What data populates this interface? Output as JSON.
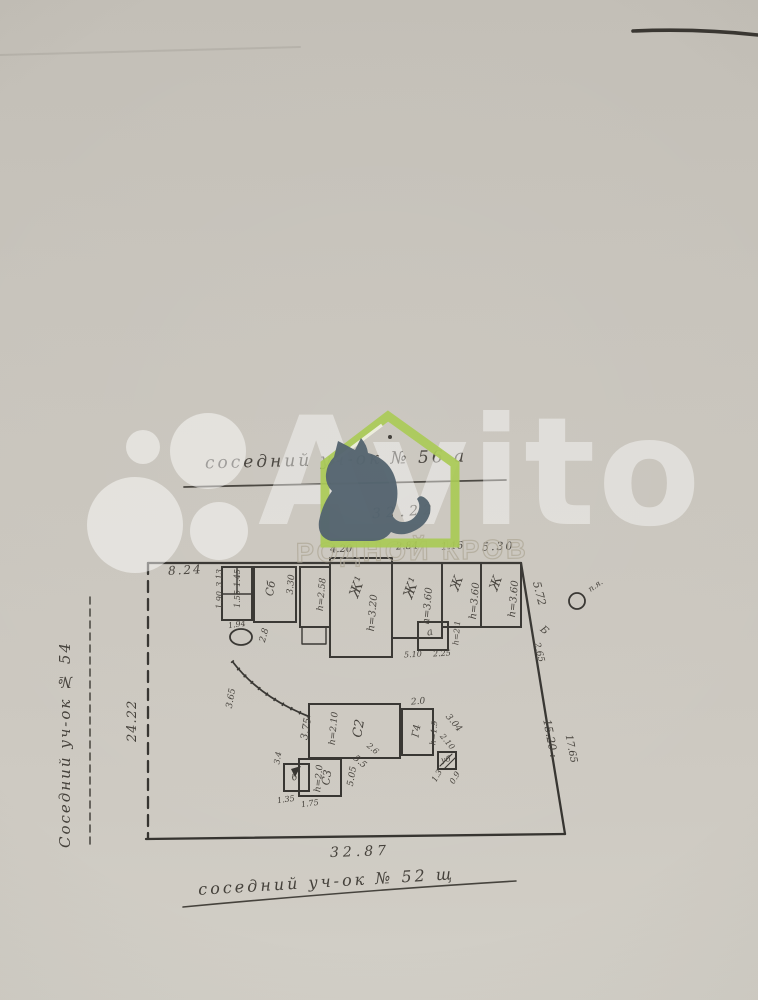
{
  "watermark": {
    "brand_text": "Avito",
    "band_text": "РОДНОЙ КРОВ",
    "colors": {
      "house_green": "#a6c84e",
      "cat_slate": "#4d5e69",
      "logo_white": "rgba(255,255,255,0.45)"
    }
  },
  "plan": {
    "neighbor_top": "соседний  уч-ок  № 56 а",
    "neighbor_left": "Соседний  уч-ок  № 54",
    "neighbor_bottom": "соседний  уч-ок  № 52 щ",
    "len_top": "32.22",
    "len_left": "24.22",
    "len_bottom": "32.87",
    "right_edge": {
      "d572": "5.72",
      "letter_b": "Б",
      "d265": "2.65",
      "post": "п.я.",
      "inner": "15.20 :",
      "outer": "17.65"
    },
    "dims_top": {
      "d824": "8.24",
      "d420": "4.20",
      "d284": "2.84",
      "d116": "1.16",
      "d530": "5.30"
    },
    "sheds": {
      "c6": "Сб",
      "d330": "3.30",
      "d313": "3.13",
      "d190": "1.90",
      "d145": "1.45",
      "d155": "1.55",
      "d194": "1.94"
    },
    "vestibule_h": "h=2.58",
    "rooms": [
      {
        "name": "Ж¹",
        "h": "h=3.20"
      },
      {
        "name": "Ж¹",
        "h": "h=3.60"
      },
      {
        "name": "Ж",
        "h": "h=3.60"
      },
      {
        "name": "Ж",
        "h": "h=3.60"
      }
    ],
    "step_room": {
      "name": "а",
      "h": "h=2.1",
      "d1": "5.10",
      "d2": "2.25"
    },
    "yard": {
      "well_d": "2.8",
      "curve_d": "3.65"
    },
    "outbuildings": {
      "c2": "С2",
      "c2_h": "h=2.10",
      "c2_left": "3.75",
      "c2_diag1": "5.5",
      "c2_diag2": "2.6",
      "c2_bottom": "5.05",
      "g4": "Г4",
      "g4_h": "h=1.9",
      "g4_top": "2.0",
      "g4_diag1": "3.04",
      "g4_diag2": "2.10",
      "ub": "уб",
      "ub_d1": "1.3",
      "ub_d2": "0.9",
      "c3": "С3",
      "c3_h": "h=2.0",
      "b": "б",
      "d135": "1.35",
      "d175": "1.75",
      "d34": "3.4"
    }
  }
}
